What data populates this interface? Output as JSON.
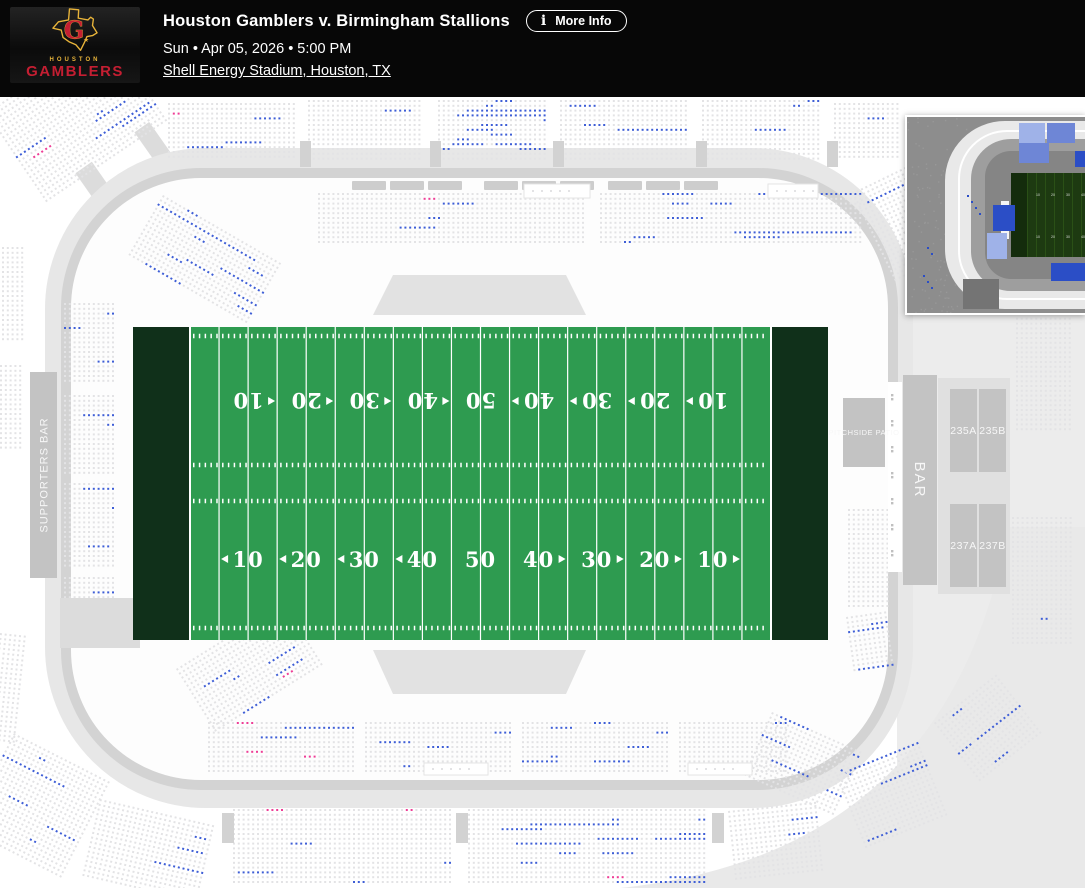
{
  "header": {
    "title": "Houston Gamblers v. Birmingham Stallions",
    "more_info": "More Info",
    "info_icon": "i",
    "date_line": "Sun • Apr 05, 2026 • 5:00 PM",
    "venue_link": "Shell Energy Stadium, Houston, TX",
    "logo": {
      "city": "HOUSTON",
      "team": "GAMBLERS",
      "letter": "G",
      "star": "★"
    }
  },
  "map": {
    "labels": {
      "supporters_bar": "SUPPORTERS BAR",
      "bar": "BAR",
      "pitchside_patio": "PITCHSIDE PATIO",
      "sections": [
        "235A",
        "235B",
        "237A",
        "237B"
      ]
    },
    "field": {
      "yard_numbers": [
        10,
        20,
        30,
        40,
        50,
        40,
        30,
        20,
        10
      ]
    },
    "colors": {
      "bg": "#ffffff",
      "seat_unavailable": "#e3e3e5",
      "seat_available": "#3e5ed6",
      "seat_resale": "#ee3d96",
      "field": "#2e9b50",
      "endzone": "#10301a",
      "line": "#ffffff",
      "bowl_fill": "#fdfdfd",
      "ring_outer": "#e7e7e7",
      "ring_inner": "#d3d3d3",
      "panel": "#ececec",
      "block": "#c3c3c3",
      "block_text": "#f7f7f7",
      "stair": "#d2d2d2",
      "strip": "#cdcdcd",
      "trapezoid": "#e2e2e2"
    },
    "sections": [
      [
        168,
        6,
        130,
        62,
        0,
        0.06,
        0.01,
        11
      ],
      [
        308,
        3,
        119,
        65,
        0,
        0.03,
        0,
        12
      ],
      [
        438,
        3,
        112,
        65,
        0,
        0.2,
        0,
        13
      ],
      [
        560,
        3,
        132,
        65,
        0,
        0.03,
        0,
        14
      ],
      [
        702,
        3,
        122,
        65,
        0,
        0.06,
        0,
        15
      ],
      [
        834,
        6,
        68,
        62,
        0,
        0.12,
        0,
        16
      ],
      [
        -14,
        16,
        150,
        115,
        -34,
        0.05,
        0.004,
        17
      ],
      [
        2,
        150,
        26,
        100,
        0,
        0.04,
        0,
        18
      ],
      [
        0,
        268,
        28,
        90,
        0,
        0.03,
        0.015,
        19
      ],
      [
        318,
        96,
        272,
        56,
        0,
        0.05,
        0.012,
        21
      ],
      [
        600,
        96,
        266,
        56,
        0,
        0.1,
        0.006,
        22
      ],
      [
        163,
        98,
        140,
        72,
        30,
        0.12,
        0,
        23
      ],
      [
        852,
        96,
        66,
        104,
        -26,
        0.08,
        0,
        24
      ],
      [
        64,
        206,
        56,
        86,
        0,
        0.05,
        0,
        25
      ],
      [
        64,
        298,
        56,
        82,
        0,
        0.07,
        0.012,
        26
      ],
      [
        64,
        386,
        56,
        88,
        0,
        0.09,
        0,
        27
      ],
      [
        64,
        480,
        56,
        72,
        0,
        0.04,
        0,
        28
      ],
      [
        848,
        412,
        44,
        102,
        0,
        0.08,
        0.012,
        29
      ],
      [
        846,
        520,
        46,
        60,
        -8,
        0.06,
        0,
        30
      ],
      [
        208,
        625,
        150,
        54,
        0,
        0.06,
        0.02,
        31
      ],
      [
        365,
        625,
        150,
        54,
        0,
        0.05,
        0.016,
        32
      ],
      [
        522,
        625,
        150,
        54,
        0,
        0.06,
        0.02,
        33
      ],
      [
        679,
        625,
        112,
        54,
        0,
        0.05,
        0.012,
        34
      ],
      [
        176,
        572,
        130,
        80,
        -32,
        0.1,
        0.01,
        35
      ],
      [
        772,
        615,
        102,
        72,
        24,
        0.05,
        0,
        36
      ],
      [
        100,
        702,
        122,
        86,
        13,
        0.03,
        0.005,
        37
      ],
      [
        233,
        712,
        222,
        78,
        0,
        0.02,
        0.005,
        38
      ],
      [
        468,
        712,
        242,
        78,
        0,
        0.05,
        0.012,
        39
      ],
      [
        728,
        714,
        92,
        76,
        -6,
        0.04,
        0.012,
        40
      ],
      [
        836,
        678,
        92,
        86,
        -22,
        0.05,
        0,
        41
      ],
      [
        934,
        626,
        86,
        80,
        -38,
        0.03,
        0,
        42
      ],
      [
        14,
        636,
        112,
        112,
        27,
        0.05,
        0.01,
        43
      ],
      [
        0,
        536,
        30,
        112,
        6,
        0.04,
        0,
        44
      ],
      [
        1012,
        420,
        66,
        132,
        0,
        0.03,
        0.008,
        45
      ],
      [
        1016,
        216,
        62,
        120,
        0,
        0.04,
        0.006,
        46
      ]
    ]
  },
  "minimap": {
    "colors": {
      "bg": "#8d8d8d",
      "band": "#e9e9e9",
      "bowl": "#9e9e9e",
      "inner": "#858585",
      "field": "#1d3a11",
      "endzone": "#142c0c",
      "stripe": "#2a5016",
      "royal": "#2b4ec6",
      "mid_blue": "#6e86d6",
      "periwinkle": "#9fb2e8",
      "light_blue": "#7d92da",
      "dark_block": "#747474",
      "strip": "#f5f5f5"
    },
    "blocks": [
      {
        "x": 112,
        "y": 6,
        "w": 26,
        "h": 20,
        "c": "periwinkle"
      },
      {
        "x": 140,
        "y": 6,
        "w": 28,
        "h": 20,
        "c": "mid_blue"
      },
      {
        "x": 112,
        "y": 26,
        "w": 30,
        "h": 20,
        "c": "mid_blue"
      },
      {
        "x": 230,
        "y": 2,
        "w": 44,
        "h": 26,
        "c": "royal"
      },
      {
        "x": 168,
        "y": 34,
        "w": 24,
        "h": 16,
        "c": "royal"
      },
      {
        "x": 198,
        "y": 36,
        "w": 30,
        "h": 14,
        "c": "royal"
      },
      {
        "x": 252,
        "y": 34,
        "w": 56,
        "h": 16,
        "c": "royal"
      },
      {
        "x": 86,
        "y": 88,
        "w": 22,
        "h": 26,
        "c": "royal"
      },
      {
        "x": 80,
        "y": 116,
        "w": 20,
        "h": 26,
        "c": "periwinkle"
      },
      {
        "x": 144,
        "y": 146,
        "w": 64,
        "h": 18,
        "c": "royal"
      },
      {
        "x": 214,
        "y": 148,
        "w": 16,
        "h": 14,
        "c": "light_blue"
      },
      {
        "x": 226,
        "y": 146,
        "w": 50,
        "h": 16,
        "c": "royal"
      },
      {
        "x": 284,
        "y": 158,
        "w": 44,
        "h": 20,
        "c": "royal"
      },
      {
        "x": 56,
        "y": 162,
        "w": 36,
        "h": 30,
        "c": "dark_block"
      }
    ]
  }
}
